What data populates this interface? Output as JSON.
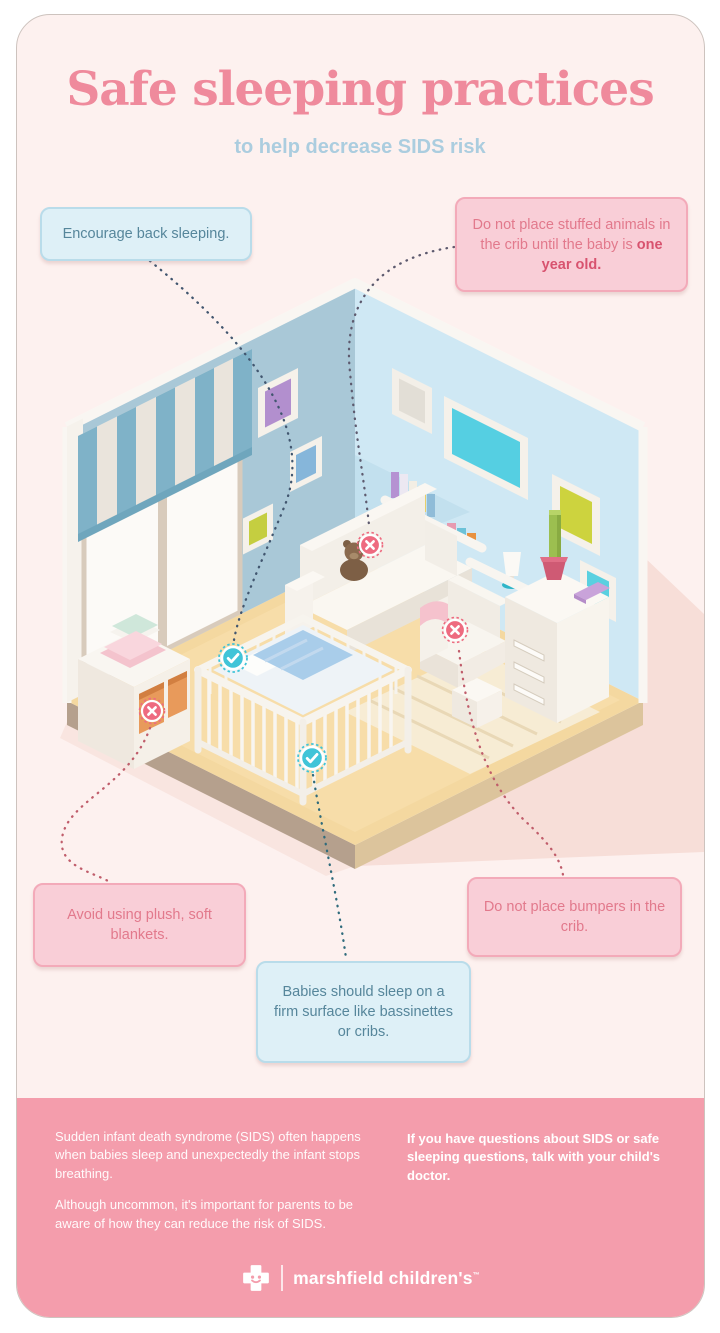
{
  "title": "Safe sleeping practices",
  "subtitle": "to help decrease SIDS risk",
  "callouts": {
    "back_sleeping": {
      "text": "Encourage back sleeping."
    },
    "stuffed_animals": {
      "text_before": "Do not place stuffed animals in the crib until the baby is ",
      "text_bold": "one year old."
    },
    "blankets": {
      "text": "Avoid using plush, soft blankets."
    },
    "bumpers": {
      "text": "Do not place bumpers in the crib."
    },
    "firm_surface": {
      "text": "Babies should sleep on a firm surface like bassinettes or cribs."
    }
  },
  "footer": {
    "para1": "Sudden infant death syndrome (SIDS) often happens when babies sleep and unexpectedly the infant stops breathing.",
    "para2": "Although uncommon, it's important for parents to be aware of how they can reduce the risk of SIDS.",
    "question": "If you have questions about SIDS or safe sleeping questions, talk with your child's doctor.",
    "logo_text": "marshfield children's",
    "trademark": "™"
  },
  "colors": {
    "title_pink": "#ef8a9c",
    "subtitle_blue": "#abcddf",
    "callout_blue_bg": "#def0f7",
    "callout_blue_border": "#b9dcea",
    "callout_blue_text": "#56869b",
    "callout_pink_bg": "#f9ced7",
    "callout_pink_border": "#f3aab9",
    "callout_pink_text": "#e2798c",
    "footer_bg": "#f49dac",
    "marker_red": "#ee6b80",
    "marker_teal": "#41c4d8",
    "leader_navy": "#41566f",
    "leader_red": "#c05d6b",
    "leader_teal": "#2f6b7c"
  }
}
